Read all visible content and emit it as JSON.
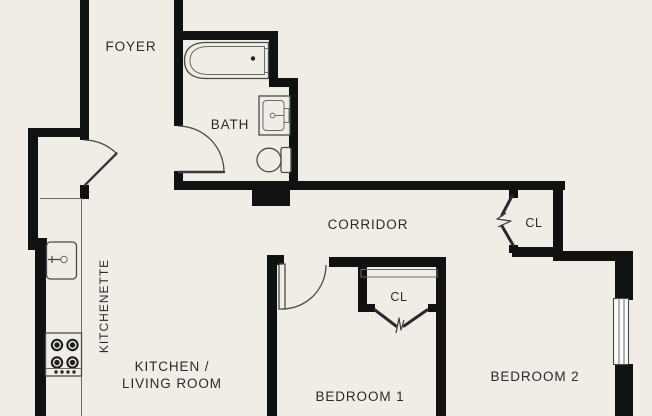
{
  "colors": {
    "background": "#f0ede6",
    "walls": "#111111",
    "fixture_lines": "#4a4a4a",
    "text": "#2b2b2b"
  },
  "rooms": [
    {
      "label": "FOYER"
    },
    {
      "label": "BATH"
    },
    {
      "label": "CORRIDOR"
    },
    {
      "label": "KITCHENETTE"
    },
    {
      "label_line1": "KITCHEN /",
      "label_line2": "LIVING ROOM"
    },
    {
      "label": "BEDROOM 1"
    },
    {
      "label": "BEDROOM 2"
    }
  ],
  "closets": [
    {
      "label": "CL"
    },
    {
      "label": "CL"
    }
  ]
}
